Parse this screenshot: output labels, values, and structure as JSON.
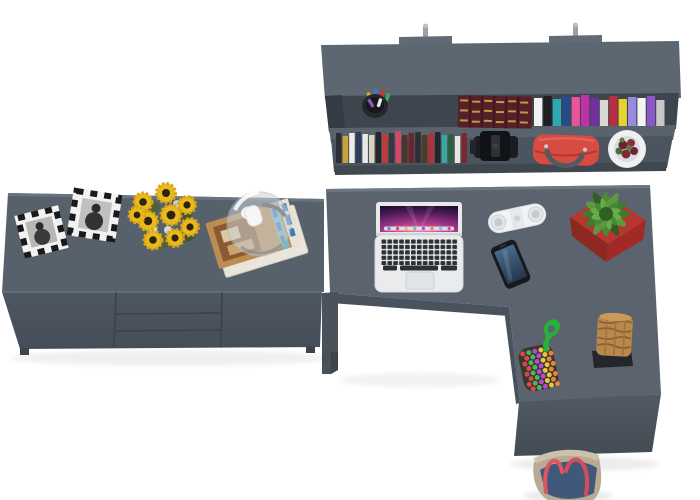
{
  "meta": {
    "description": "Top-down 3D render of a gray office furniture set: wall shelf with books, long sideboard with decor, and an L-shaped desk with laptop",
    "canvas": {
      "width": 700,
      "height": 500
    }
  },
  "palette": {
    "background": "#ffffff",
    "furniture_top": "#5a636e",
    "furniture_top_light": "#626c77",
    "furniture_front": "#4c5560",
    "furniture_front_dark": "#434c55",
    "furniture_recess": "#3e454e",
    "furniture_leg": "#49525b",
    "edge_highlight": "#6e7884"
  },
  "shelf": {
    "name": "wall shelf with two book rows",
    "bracket_color": "#616b76",
    "pin_color": "#9aa1a9",
    "books_top": [
      {
        "c": "#f2f2f0",
        "h": 28
      },
      {
        "c": "#1c1e22",
        "h": 30
      },
      {
        "c": "#2ba8b0",
        "h": 27
      },
      {
        "c": "#274a88",
        "h": 30
      },
      {
        "c": "#e8559a",
        "h": 29
      },
      {
        "c": "#c030a8",
        "h": 31
      },
      {
        "c": "#7030a0",
        "h": 28
      },
      {
        "c": "#d8d8d6",
        "h": 26
      },
      {
        "c": "#b83040",
        "h": 30
      },
      {
        "c": "#e8d22e",
        "h": 27
      },
      {
        "c": "#988ae0",
        "h": 29
      },
      {
        "c": "#f4f4f2",
        "h": 28
      },
      {
        "c": "#8a56c8",
        "h": 30
      },
      {
        "c": "#c8c8c6",
        "h": 26
      }
    ],
    "books_bottom": [
      {
        "c": "#2b2e33",
        "h": 30
      },
      {
        "c": "#c8a23a",
        "h": 27
      },
      {
        "c": "#ececea",
        "h": 30
      },
      {
        "c": "#2e3d5c",
        "h": 31
      },
      {
        "c": "#e8e8e6",
        "h": 29
      },
      {
        "c": "#d8d2c0",
        "h": 28
      },
      {
        "c": "#23252a",
        "h": 31
      },
      {
        "c": "#c03a3a",
        "h": 29
      },
      {
        "c": "#35383e",
        "h": 30
      },
      {
        "c": "#d4476a",
        "h": 32
      },
      {
        "c": "#4a3526",
        "h": 28
      },
      {
        "c": "#6e2430",
        "h": 30
      },
      {
        "c": "#2c2f35",
        "h": 31
      },
      {
        "c": "#503a28",
        "h": 28
      },
      {
        "c": "#b03238",
        "h": 30
      },
      {
        "c": "#24262b",
        "h": 31
      },
      {
        "c": "#3aa8a0",
        "h": 28
      },
      {
        "c": "#2e5e40",
        "h": 29
      },
      {
        "c": "#e6e6e4",
        "h": 27
      },
      {
        "c": "#7a2828",
        "h": 30
      }
    ],
    "antique_stack_color": "#55202a",
    "antique_gold": "#c09a40",
    "camera_color": "#17191d",
    "bag_color": "#d84b42",
    "pot_color": "#eef0f2",
    "pen_cup_color": "#24272c",
    "pen_colors": [
      "#d8a020",
      "#3a78c8",
      "#c83a3a",
      "#3aa860",
      "#8858c0",
      "#e8e8e8"
    ]
  },
  "sideboard": {
    "name": "sideboard with two doors and three drawers",
    "frame_border": "#1a1a1a",
    "frame_fill": "#f2f2f2",
    "sunflower_petal": "#e8ba1e",
    "sunflower_center": "#2f2310",
    "leaf_color": "#51603a",
    "magazine_cover": "#bc8c52",
    "magazine_pages": "#e9e5db",
    "magazine_accent": "#3a7abf",
    "dome_glass": "#ccd3d8"
  },
  "desk": {
    "name": "L-shaped desk",
    "laptop": {
      "body": "#e9ebed",
      "screen_bezel": "#e7e9eb",
      "key_color": "#2d3035",
      "trackpad": "#e2e4e6",
      "dock_colors": [
        "#4a90d9",
        "#d94a4a",
        "#d9c44a",
        "#4ad98a",
        "#9a4ad9",
        "#d9884a",
        "#4ad9d9",
        "#d94a90"
      ],
      "wallpaper": [
        "#f3a7d8",
        "#d9569f",
        "#8e2f7e",
        "#4a1a55",
        "#1a0a28"
      ]
    },
    "speaker": {
      "body": "#f1f3f4",
      "grille": "#c6cbcf"
    },
    "smartphone": {
      "body": "#17191d",
      "screen_top": "#4a6a8c",
      "screen_bottom": "#23364c"
    },
    "plant": {
      "pot": "#b5372f",
      "pot_dark": "#8e2823",
      "leaf_a": "#3f7a2e",
      "leaf_b": "#5a9a40",
      "leaf_c": "#2f5f22"
    },
    "bead_bag": {
      "base": "#3a3530",
      "cord": "#27b03a",
      "bead_colors": [
        "#d84a4a",
        "#e8c83a",
        "#4a78d8",
        "#48b85a",
        "#e8853a",
        "#e8e8e8",
        "#b84ad8",
        "#3ac8c8"
      ]
    },
    "basket": {
      "body": "#b8894a",
      "weave": "#8a6132",
      "base": "#23262b"
    }
  },
  "floor": {
    "tote_bag": {
      "canvas": "#b7ab96",
      "denim": "#40597a",
      "rim": "#cdc1ab",
      "handle": "#e05562"
    }
  }
}
